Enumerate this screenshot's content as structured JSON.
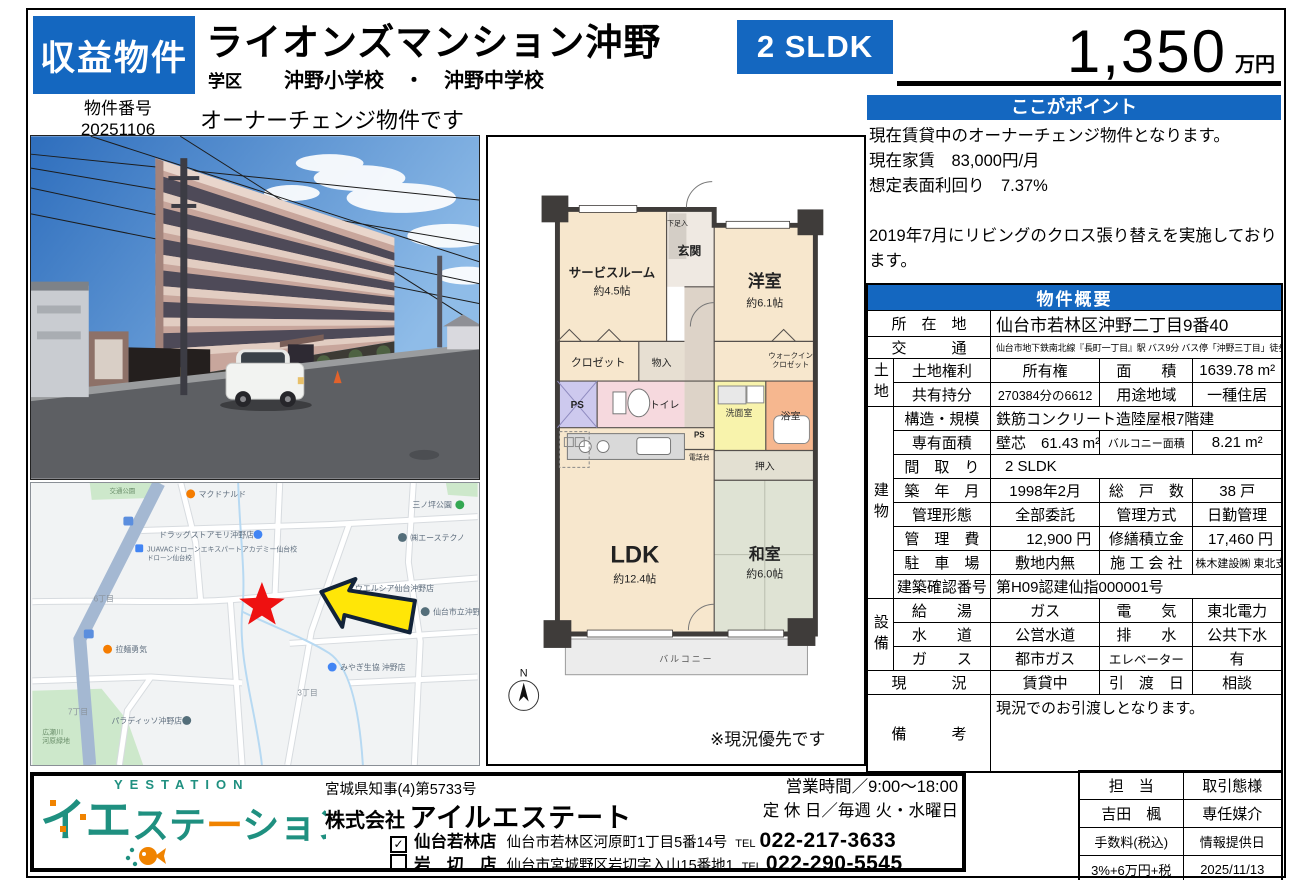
{
  "header": {
    "badge": "収益物件",
    "title": "ライオンズマンション沖野",
    "school_label": "学区",
    "schools": "沖野小学校　・　沖野中学校",
    "property_no_label": "物件番号",
    "property_no": "20251106",
    "owner_note": "オーナーチェンジ物件です",
    "layout_badge": "2 SLDK",
    "price": "1,350",
    "price_unit": "万円"
  },
  "point": {
    "title": "ここがポイント",
    "line1": "現在賃貸中のオーナーチェンジ物件となります。",
    "line2": "現在家賃　83,000円/月",
    "line3": "想定表面利回り　7.37%",
    "line4": "2019年7月にリビングのクロス張り替えを実施しております。"
  },
  "overview": {
    "title": "物件概要",
    "location_label": "所　在　地",
    "location": "仙台市若林区沖野二丁目9番40",
    "access_label": "交　　　通",
    "access": "仙台市地下鉄南北線『長町一丁目』駅 バス9分 バス停「沖野三丁目」徒歩3分",
    "group_land": "土地",
    "land_right_label": "土地権利",
    "land_right": "所有権",
    "land_area_label": "面　　積",
    "land_area": "1639.78 m²",
    "share_label": "共有持分",
    "share": "270384分の6612",
    "zoning_label": "用途地域",
    "zoning": "一種住居",
    "group_building": "建物",
    "structure_label": "構造・規模",
    "structure": "鉄筋コンクリート造陸屋根7階建",
    "exclusive_label": "専有面積",
    "exclusive": "壁芯　61.43 m²",
    "balcony_label": "バルコニー面積",
    "balcony": "8.21 m²",
    "plan_label": "間　取　り",
    "plan": "2 SLDK",
    "built_label": "築　年　月",
    "built": "1998年2月",
    "units_label": "総　戸　数",
    "units": "38 戸",
    "mgmt_form_label": "管理形態",
    "mgmt_form": "全部委託",
    "mgmt_style_label": "管理方式",
    "mgmt_style": "日勤管理",
    "mgmt_fee_label": "管　理　費",
    "mgmt_fee": "12,900 円",
    "reserve_label": "修繕積立金",
    "reserve": "17,460 円",
    "parking_label": "駐　車　場",
    "parking": "敷地内無",
    "builder_label": "施 工 会 社",
    "builder": "株木建設㈱ 東北支店",
    "confirm_label": "建築確認番号",
    "confirm_no": "第H09認建仙指000001号",
    "group_facility": "設備",
    "hot_water_label": "給　　湯",
    "hot_water": "ガス",
    "electricity_label": "電　　気",
    "electricity": "東北電力",
    "water_label": "水　　道",
    "water": "公営水道",
    "drainage_label": "排　　水",
    "drainage": "公共下水",
    "gas_label": "ガ　　ス",
    "gas": "都市ガス",
    "elevator_label": "エレベーター",
    "elevator": "有",
    "status_label": "現　　　況",
    "status": "賃貸中",
    "handover_label": "引　渡　日",
    "handover": "相談",
    "remarks_label": "備　　　考",
    "remarks": "現況でのお引渡しとなります。"
  },
  "floorplan": {
    "entrance": "玄関",
    "shoe_box": "下足入",
    "western_room": "洋室",
    "western_size": "約6.1帖",
    "service_room": "サービスルーム",
    "service_size": "約4.5帖",
    "closet": "クロゼット",
    "storage": "物入",
    "ps1": "PS",
    "toilet": "トイレ",
    "washroom": "洗面室",
    "bathroom": "浴室",
    "wic_line1": "ウォークイン",
    "wic_line2": "クロゼット",
    "ps2": "PS",
    "phone_stand": "電話台",
    "oshiire": "押入",
    "ldk": "LDK",
    "ldk_size": "約12.4帖",
    "japanese_room": "和室",
    "japanese_size": "約6.0帖",
    "balcony": "バルコニー",
    "compass": "N",
    "note": "※現況優先です"
  },
  "map": {
    "labels": [
      {
        "text": "マクドナルド"
      },
      {
        "text": "ドラッグストアモリ沖野店"
      },
      {
        "text": "JUAVACドローンエキスパートアカデミー仙台校"
      },
      {
        "text": "ドローン仙台校"
      },
      {
        "text": "三ノ坪公園"
      },
      {
        "text": "㈱エーステクノ"
      },
      {
        "text": "ウエルシア仙台沖野店"
      },
      {
        "text": "仙台市立沖野中"
      },
      {
        "text": "みやぎ生協 沖野店"
      },
      {
        "text": "拉麺勇気"
      },
      {
        "text": "パラディッソ沖野店"
      },
      {
        "text": "広瀬川"
      },
      {
        "text": "河原緑地"
      },
      {
        "text": "6丁目"
      },
      {
        "text": "7丁目"
      },
      {
        "text": "3丁目"
      },
      {
        "text": "交通公園"
      }
    ]
  },
  "footer": {
    "logo_en": "YESTATION",
    "logo_jp_a": "イエ",
    "logo_jp_b1": "ステ",
    "logo_jp_b2": "ー",
    "logo_jp_b3": "ション",
    "license": "宮城県知事(4)第5733号",
    "company_prefix": "株式会社",
    "company_name": "アイルエステート",
    "hours": "営業時間／9:00～18:00",
    "holiday": "定 休 日／毎週 火・水曜日",
    "store1_check": "✓",
    "store1_name": "仙台若林店",
    "store1_address": "仙台市若林区河原町1丁目5番14号",
    "store1_tel_label": "TEL",
    "store1_tel": "022-217-3633",
    "store2_name": "岩　切　店",
    "store2_address": "仙台市宮城野区岩切字入山15番地1",
    "store2_tel_label": "TEL",
    "store2_tel": "022-290-5545",
    "agent": {
      "staff_label": "担　当",
      "staff": "吉田　楓",
      "type_label": "取引態様",
      "type": "専任媒介",
      "fee_label": "手数料(税込)",
      "fee": "3%+6万円+税",
      "date_label": "情報提供日",
      "date": "2025/11/13"
    }
  }
}
